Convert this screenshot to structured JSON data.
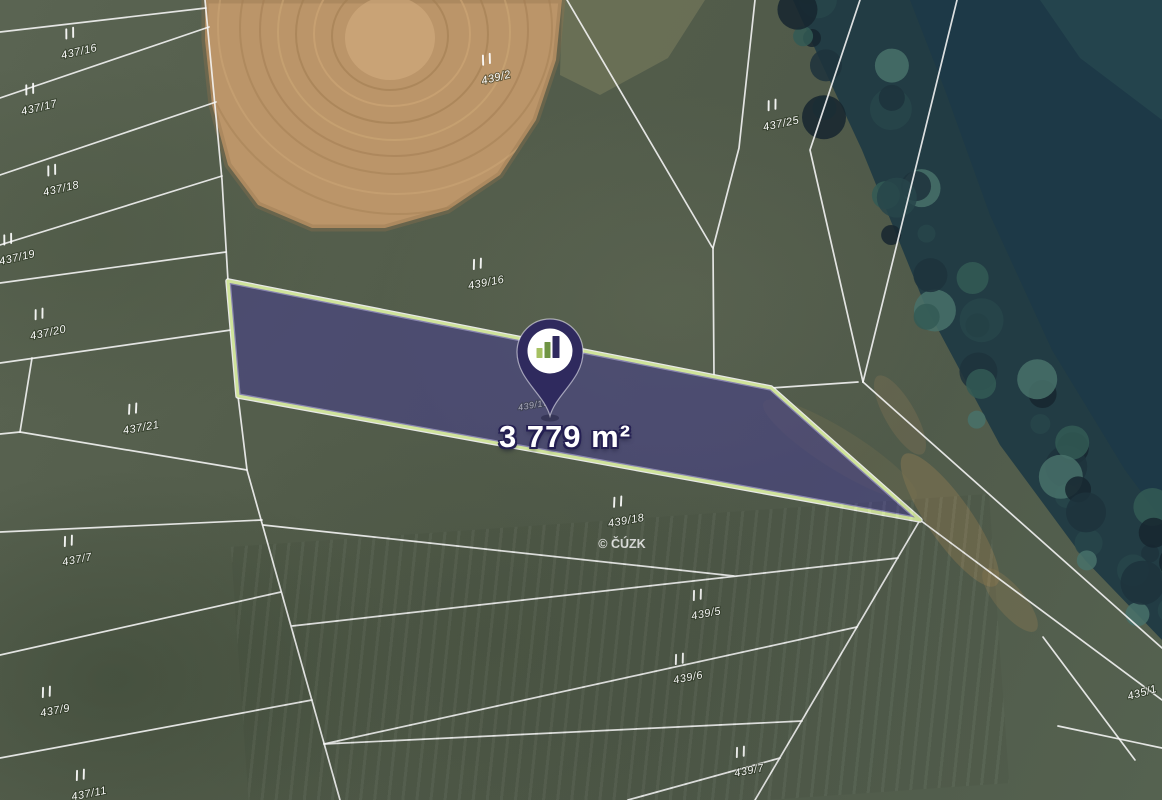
{
  "map": {
    "area_label": "3 779 m²",
    "attribution": "© ČÚZK",
    "colors": {
      "grass": "#57614e",
      "field": "#bb9569",
      "water": "#1d3947",
      "trees": "#223c44",
      "boundary_line": "#f7f7f7",
      "highlight_fill": "#46408a",
      "highlight_stroke": "#cfe39b",
      "pin_body": "#2f2a5e"
    },
    "highlight": {
      "points": [
        [
          228,
          281
        ],
        [
          771,
          388
        ],
        [
          920,
          520
        ],
        [
          238,
          396
        ]
      ],
      "fill_opacity": 0.58
    },
    "pin": {
      "x": 550,
      "y": 352,
      "bar_colors": [
        "#a6c162",
        "#6f9444",
        "#2f2a5e"
      ]
    },
    "parcels": [
      {
        "label": "437/16",
        "x": 79,
        "y": 51,
        "rot": -13
      },
      {
        "label": "437/17",
        "x": 39,
        "y": 107,
        "rot": -13
      },
      {
        "label": "437/18",
        "x": 61,
        "y": 188,
        "rot": -13
      },
      {
        "label": "437/19",
        "x": 17,
        "y": 257,
        "rot": -13
      },
      {
        "label": "437/20",
        "x": 48,
        "y": 332,
        "rot": -12
      },
      {
        "label": "437/21",
        "x": 141,
        "y": 427,
        "rot": -10
      },
      {
        "label": "439/2",
        "x": 496,
        "y": 77,
        "rot": -14
      },
      {
        "label": "437/25",
        "x": 781,
        "y": 123,
        "rot": -12
      },
      {
        "label": "439/16",
        "x": 486,
        "y": 282,
        "rot": -11
      },
      {
        "label": "439/17",
        "x": 533,
        "y": 404,
        "rot": -10,
        "faint": true,
        "size": 9,
        "ticks": false
      },
      {
        "label": "439/18",
        "x": 626,
        "y": 520,
        "rot": -10
      },
      {
        "label": "437/7",
        "x": 77,
        "y": 559,
        "rot": -11
      },
      {
        "label": "439/5",
        "x": 706,
        "y": 613,
        "rot": -11
      },
      {
        "label": "439/6",
        "x": 688,
        "y": 677,
        "rot": -11
      },
      {
        "label": "437/9",
        "x": 55,
        "y": 710,
        "rot": -11
      },
      {
        "label": "435/1",
        "x": 1142,
        "y": 692,
        "rot": -16,
        "ticks": false
      },
      {
        "label": "439/7",
        "x": 749,
        "y": 770,
        "rot": -11
      },
      {
        "label": "437/11",
        "x": 89,
        "y": 793,
        "rot": -11
      }
    ],
    "boundaries": [
      [
        [
          205,
          0
        ],
        [
          222,
          180
        ],
        [
          228,
          281
        ]
      ],
      [
        [
          238,
          396
        ],
        [
          247,
          470
        ],
        [
          340,
          800
        ]
      ],
      [
        [
          0,
          32
        ],
        [
          206,
          8
        ]
      ],
      [
        [
          0,
          98
        ],
        [
          209,
          27
        ]
      ],
      [
        [
          0,
          175
        ],
        [
          216,
          102
        ]
      ],
      [
        [
          0,
          245
        ],
        [
          222,
          176
        ]
      ],
      [
        [
          0,
          283
        ],
        [
          226,
          252
        ]
      ],
      [
        [
          0,
          363
        ],
        [
          231,
          330
        ]
      ],
      [
        [
          32,
          358
        ],
        [
          20,
          432
        ]
      ],
      [
        [
          0,
          434
        ],
        [
          20,
          432
        ],
        [
          247,
          470
        ]
      ],
      [
        [
          0,
          532
        ],
        [
          262,
          520
        ]
      ],
      [
        [
          0,
          655
        ],
        [
          281,
          592
        ]
      ],
      [
        [
          0,
          758
        ],
        [
          312,
          700
        ]
      ],
      [
        [
          263,
          525
        ],
        [
          734,
          576
        ]
      ],
      [
        [
          292,
          626
        ],
        [
          898,
          558
        ]
      ],
      [
        [
          324,
          744
        ],
        [
          857,
          627
        ]
      ],
      [
        [
          324,
          744
        ],
        [
          802,
          721
        ]
      ],
      [
        [
          628,
          800
        ],
        [
          780,
          758
        ]
      ],
      [
        [
          920,
          520
        ],
        [
          755,
          800
        ]
      ],
      [
        [
          920,
          520
        ],
        [
          1162,
          700
        ]
      ],
      [
        [
          863,
          382
        ],
        [
          1162,
          648
        ]
      ],
      [
        [
          771,
          388
        ],
        [
          858,
          382
        ]
      ],
      [
        [
          567,
          0
        ],
        [
          712,
          247
        ]
      ],
      [
        [
          755,
          0
        ],
        [
          739,
          148
        ],
        [
          713,
          248
        ]
      ],
      [
        [
          713,
          248
        ],
        [
          714,
          376
        ]
      ],
      [
        [
          860,
          0
        ],
        [
          810,
          150
        ],
        [
          863,
          382
        ]
      ],
      [
        [
          957,
          0
        ],
        [
          863,
          382
        ]
      ],
      [
        [
          1043,
          637
        ],
        [
          1135,
          760
        ]
      ],
      [
        [
          1058,
          726
        ],
        [
          1162,
          748
        ]
      ]
    ]
  }
}
